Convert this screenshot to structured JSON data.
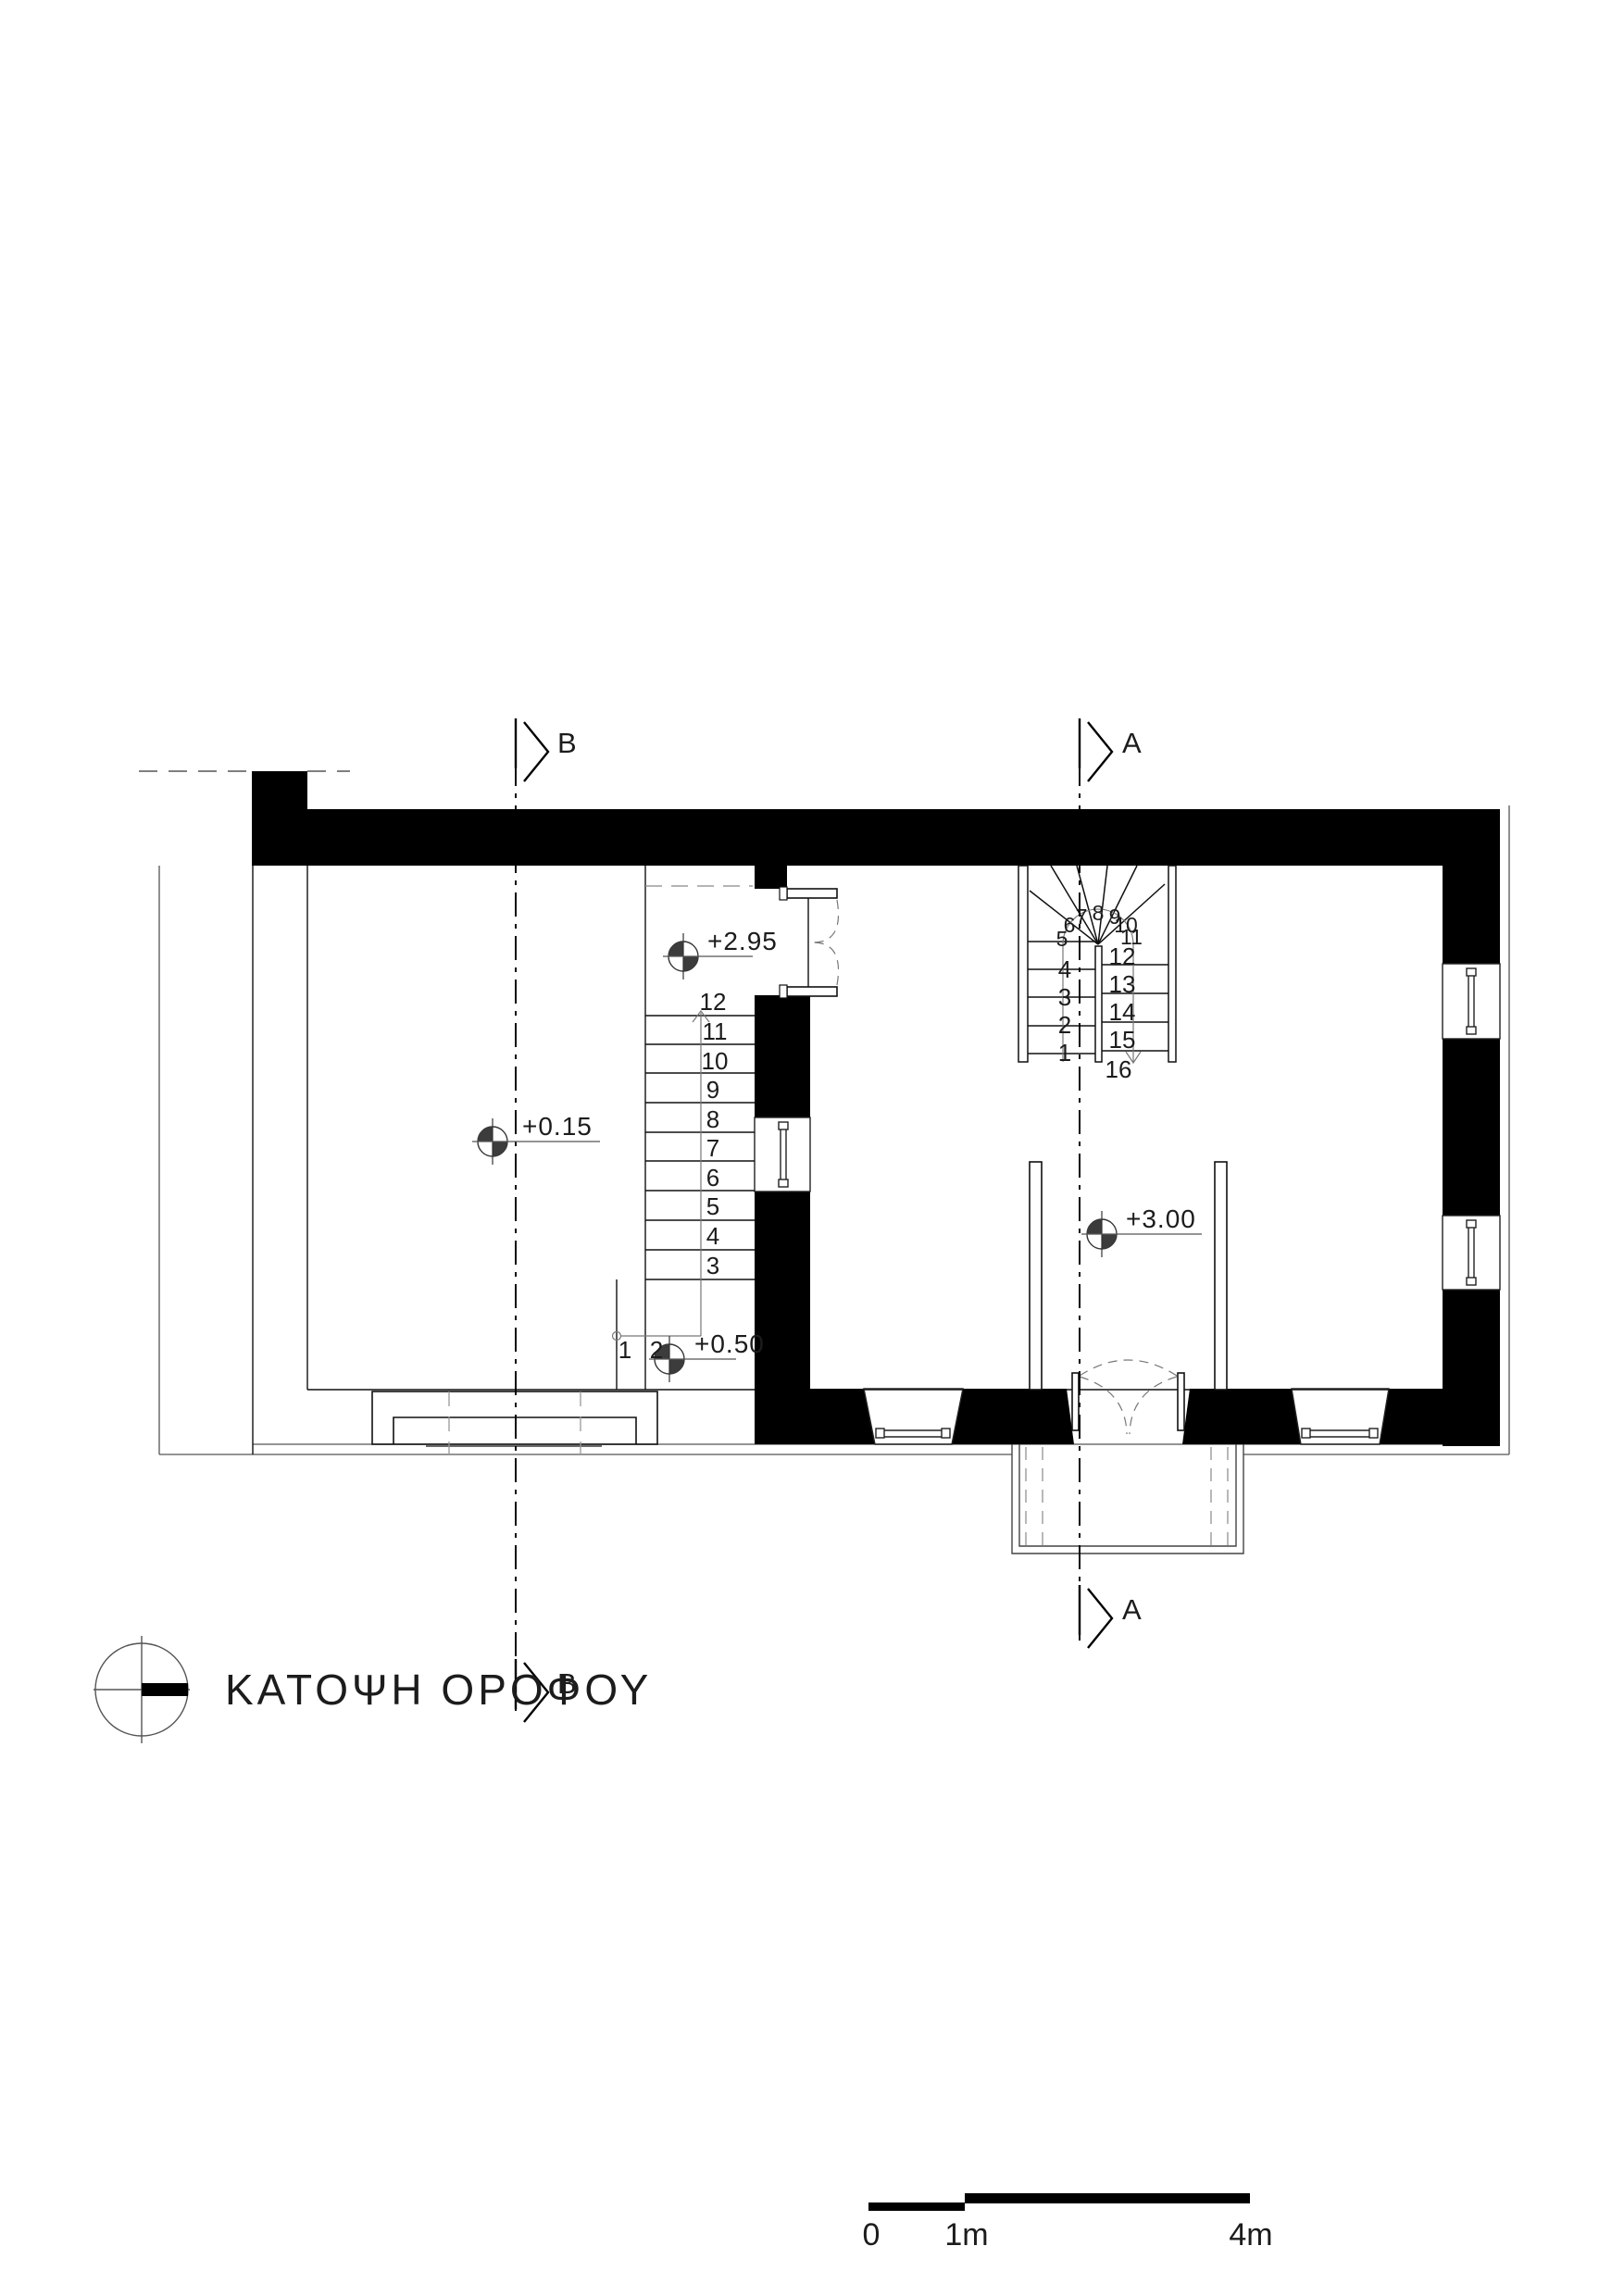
{
  "title": "ΚΑΤΟΨΗ ΟΡΟΦΟΥ",
  "sections": {
    "a": "A",
    "b": "B"
  },
  "levels": {
    "v295": "+2.95",
    "v015": "+0.15",
    "v050": "+0.50",
    "v300": "+3.00"
  },
  "stair_straight": {
    "steps": [
      "1",
      "2",
      "3",
      "4",
      "5",
      "6",
      "7",
      "8",
      "9",
      "10",
      "11",
      "12"
    ]
  },
  "stair_u": {
    "left": [
      "1",
      "2",
      "3",
      "4"
    ],
    "winders": [
      "5",
      "6",
      "7",
      "8",
      "9",
      "10",
      "11"
    ],
    "right": [
      "12",
      "13",
      "14",
      "15",
      "16"
    ]
  },
  "scale_bar": {
    "t0": "0",
    "t1": "1m",
    "t4": "4m"
  },
  "colors": {
    "ink": "#000000",
    "guide_grey": "#808080"
  }
}
